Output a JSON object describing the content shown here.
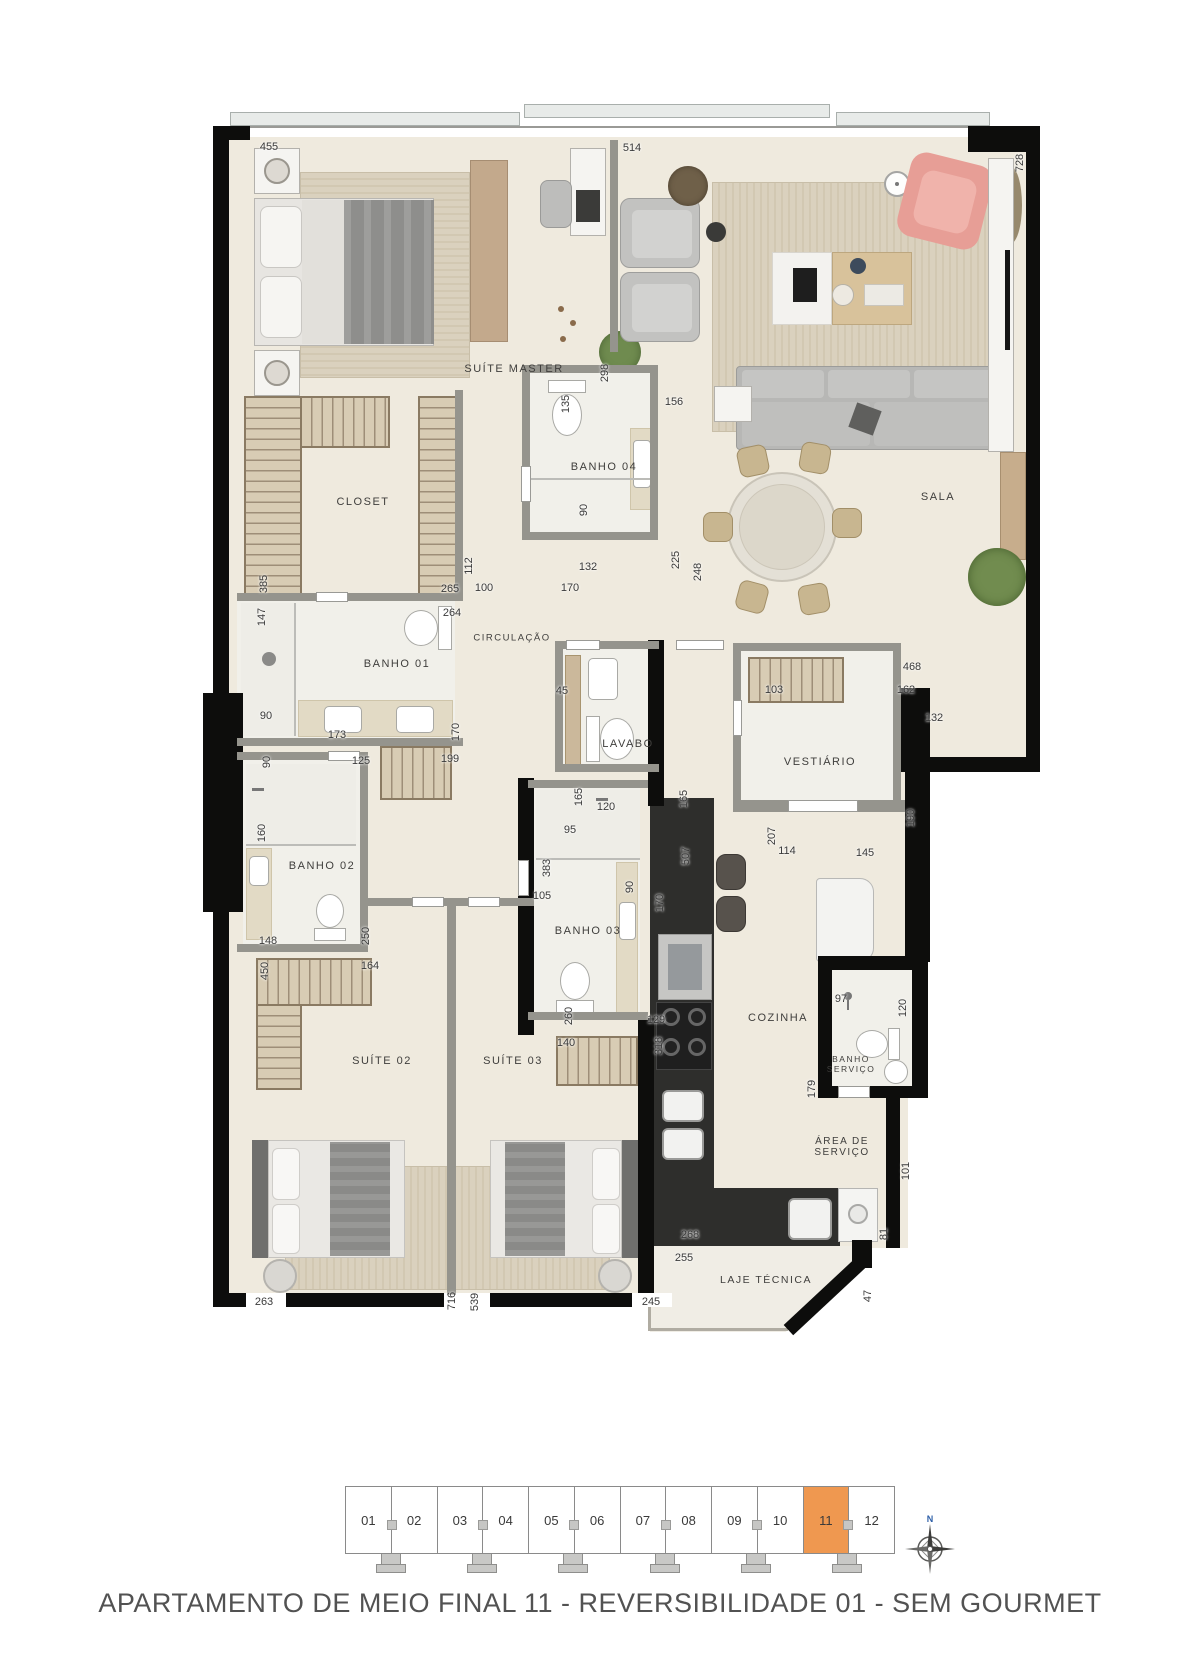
{
  "meta": {
    "caption": "APARTAMENTO DE MEIO FINAL 11 - REVERSIBILIDADE 01 - SEM GOURMET"
  },
  "compass": {
    "north_label": "N",
    "north_color": "#2e5fa8"
  },
  "key_plan": {
    "units": [
      "01",
      "02",
      "03",
      "04",
      "05",
      "06",
      "07",
      "08",
      "09",
      "10",
      "11",
      "12"
    ],
    "highlighted_unit": "11",
    "highlight_color": "#ef9850"
  },
  "colors": {
    "wall": "#0d0d0c",
    "floor": "#efeade",
    "counter": "#2e2e2c",
    "accent_chair": "#e79e96",
    "wood": "#d8ccb4",
    "highlight": "#ef9850"
  },
  "rooms": [
    {
      "id": "suite-master",
      "label": "SUÍTE MASTER",
      "x": 514,
      "y": 369
    },
    {
      "id": "sala",
      "label": "SALA",
      "x": 938,
      "y": 497
    },
    {
      "id": "closet",
      "label": "CLOSET",
      "x": 363,
      "y": 502
    },
    {
      "id": "banho-04",
      "label": "BANHO 04",
      "x": 604,
      "y": 467
    },
    {
      "id": "circulacao",
      "label": "CIRCULAÇÃO",
      "x": 512,
      "y": 638,
      "size": 9.5
    },
    {
      "id": "banho-01",
      "label": "BANHO 01",
      "x": 397,
      "y": 664
    },
    {
      "id": "lavabo",
      "label": "LAVABO",
      "x": 628,
      "y": 744
    },
    {
      "id": "vestiario",
      "label": "VESTIÁRIO",
      "x": 820,
      "y": 762
    },
    {
      "id": "banho-02",
      "label": "BANHO 02",
      "x": 322,
      "y": 866
    },
    {
      "id": "banho-03",
      "label": "BANHO 03",
      "x": 588,
      "y": 931
    },
    {
      "id": "cozinha",
      "label": "COZINHA",
      "x": 778,
      "y": 1018
    },
    {
      "id": "banho-servico",
      "label": "BANHO\nSERVIÇO",
      "x": 851,
      "y": 1064,
      "size": 8.5
    },
    {
      "id": "area-servico",
      "label": "ÁREA DE\nSERVIÇO",
      "x": 842,
      "y": 1147,
      "size": 10
    },
    {
      "id": "laje-tecnica",
      "label": "LAJE TÉCNICA",
      "x": 766,
      "y": 1280,
      "size": 10.5
    },
    {
      "id": "suite-02",
      "label": "SUÍTE 02",
      "x": 382,
      "y": 1061
    },
    {
      "id": "suite-03",
      "label": "SUÍTE 03",
      "x": 513,
      "y": 1061
    }
  ],
  "dimensions": [
    {
      "t": "455",
      "x": 269,
      "y": 147,
      "o": "h"
    },
    {
      "t": "514",
      "x": 632,
      "y": 148,
      "o": "h"
    },
    {
      "t": "728",
      "x": 1020,
      "y": 163,
      "o": "v"
    },
    {
      "t": "298",
      "x": 605,
      "y": 373,
      "o": "v"
    },
    {
      "t": "135",
      "x": 566,
      "y": 404,
      "o": "v"
    },
    {
      "t": "156",
      "x": 674,
      "y": 402,
      "o": "h"
    },
    {
      "t": "90",
      "x": 584,
      "y": 510,
      "o": "v"
    },
    {
      "t": "132",
      "x": 588,
      "y": 567,
      "o": "h"
    },
    {
      "t": "225",
      "x": 676,
      "y": 560,
      "o": "v"
    },
    {
      "t": "248",
      "x": 698,
      "y": 572,
      "o": "v"
    },
    {
      "t": "170",
      "x": 570,
      "y": 588,
      "o": "h"
    },
    {
      "t": "112",
      "x": 469,
      "y": 566,
      "o": "v"
    },
    {
      "t": "100",
      "x": 484,
      "y": 588,
      "o": "h"
    },
    {
      "t": "265",
      "x": 450,
      "y": 589,
      "o": "h"
    },
    {
      "t": "385",
      "x": 264,
      "y": 584,
      "o": "v"
    },
    {
      "t": "147",
      "x": 262,
      "y": 617,
      "o": "v"
    },
    {
      "t": "264",
      "x": 452,
      "y": 613,
      "o": "h"
    },
    {
      "t": "90",
      "x": 266,
      "y": 716,
      "o": "h"
    },
    {
      "t": "173",
      "x": 337,
      "y": 735,
      "o": "h"
    },
    {
      "t": "170",
      "x": 456,
      "y": 732,
      "o": "v"
    },
    {
      "t": "90",
      "x": 267,
      "y": 762,
      "o": "v"
    },
    {
      "t": "125",
      "x": 361,
      "y": 761,
      "o": "h"
    },
    {
      "t": "199",
      "x": 450,
      "y": 759,
      "o": "h"
    },
    {
      "t": "160",
      "x": 262,
      "y": 833,
      "o": "v"
    },
    {
      "t": "148",
      "x": 268,
      "y": 941,
      "o": "h"
    },
    {
      "t": "250",
      "x": 366,
      "y": 936,
      "o": "v"
    },
    {
      "t": "450",
      "x": 265,
      "y": 971,
      "o": "v"
    },
    {
      "t": "164",
      "x": 370,
      "y": 966,
      "o": "h"
    },
    {
      "t": "45",
      "x": 562,
      "y": 691,
      "o": "h"
    },
    {
      "t": "165",
      "x": 579,
      "y": 797,
      "o": "v"
    },
    {
      "t": "120",
      "x": 606,
      "y": 807,
      "o": "h"
    },
    {
      "t": "165",
      "x": 684,
      "y": 799,
      "o": "v"
    },
    {
      "t": "103",
      "x": 774,
      "y": 690,
      "o": "h"
    },
    {
      "t": "468",
      "x": 912,
      "y": 667,
      "o": "h"
    },
    {
      "t": "162",
      "x": 906,
      "y": 690,
      "o": "h"
    },
    {
      "t": "132",
      "x": 934,
      "y": 718,
      "o": "h"
    },
    {
      "t": "190",
      "x": 911,
      "y": 818,
      "o": "v"
    },
    {
      "t": "207",
      "x": 772,
      "y": 836,
      "o": "v"
    },
    {
      "t": "114",
      "x": 787,
      "y": 851,
      "o": "h"
    },
    {
      "t": "145",
      "x": 865,
      "y": 853,
      "o": "h"
    },
    {
      "t": "507",
      "x": 686,
      "y": 856,
      "o": "v"
    },
    {
      "t": "95",
      "x": 570,
      "y": 830,
      "o": "h"
    },
    {
      "t": "383",
      "x": 547,
      "y": 868,
      "o": "v"
    },
    {
      "t": "105",
      "x": 542,
      "y": 896,
      "o": "h"
    },
    {
      "t": "90",
      "x": 630,
      "y": 887,
      "o": "v"
    },
    {
      "t": "170",
      "x": 660,
      "y": 903,
      "o": "v"
    },
    {
      "t": "260",
      "x": 569,
      "y": 1016,
      "o": "v"
    },
    {
      "t": "129",
      "x": 656,
      "y": 1020,
      "o": "h"
    },
    {
      "t": "140",
      "x": 566,
      "y": 1043,
      "o": "h"
    },
    {
      "t": "318",
      "x": 659,
      "y": 1046,
      "o": "v"
    },
    {
      "t": "97",
      "x": 841,
      "y": 999,
      "o": "h"
    },
    {
      "t": "120",
      "x": 903,
      "y": 1008,
      "o": "v"
    },
    {
      "t": "179",
      "x": 812,
      "y": 1089,
      "o": "v"
    },
    {
      "t": "101",
      "x": 906,
      "y": 1171,
      "o": "v"
    },
    {
      "t": "268",
      "x": 690,
      "y": 1235,
      "o": "h"
    },
    {
      "t": "81",
      "x": 884,
      "y": 1234,
      "o": "v"
    },
    {
      "t": "255",
      "x": 684,
      "y": 1258,
      "o": "h"
    },
    {
      "t": "47",
      "x": 868,
      "y": 1296,
      "o": "v"
    },
    {
      "t": "263",
      "x": 264,
      "y": 1302,
      "o": "h"
    },
    {
      "t": "716",
      "x": 452,
      "y": 1301,
      "o": "v"
    },
    {
      "t": "539",
      "x": 475,
      "y": 1302,
      "o": "v"
    },
    {
      "t": "245",
      "x": 651,
      "y": 1302,
      "o": "h"
    }
  ]
}
